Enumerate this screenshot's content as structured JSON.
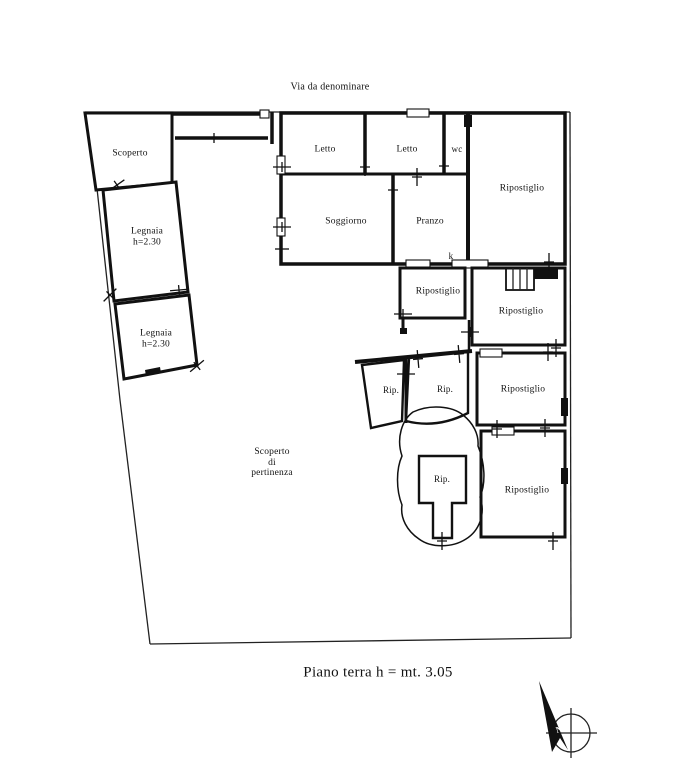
{
  "street_label": "Via da denominare",
  "caption": "Piano terra h = mt. 3.05",
  "rooms": {
    "scoperto": {
      "label": "Scoperto"
    },
    "legnaia_upper": {
      "label": "Legnaia",
      "height": "h=2.30"
    },
    "legnaia_lower": {
      "label": "Legnaia",
      "height": "h=2.30"
    },
    "letto_left": {
      "label": "Letto"
    },
    "letto_right": {
      "label": "Letto"
    },
    "wc": {
      "label": "wc"
    },
    "soggiorno": {
      "label": "Soggiorno"
    },
    "pranzo": {
      "label": "Pranzo"
    },
    "kitchen_mark": {
      "label": "k"
    },
    "ripostiglio_top_right": {
      "label": "Ripostiglio"
    },
    "ripostiglio_center": {
      "label": "Ripostiglio"
    },
    "ripostiglio_stair": {
      "label": "Ripostiglio"
    },
    "rip_small_left": {
      "label": "Rip."
    },
    "rip_small_right": {
      "label": "Rip."
    },
    "ripostiglio_mid_right": {
      "label": "Ripostiglio"
    },
    "ripostiglio_bottom_right": {
      "label": "Ripostiglio"
    },
    "rip_island": {
      "label": "Rip."
    },
    "courtyard": {
      "line1": "Scoperto",
      "line2": "di",
      "line3": "pertinenza"
    }
  },
  "compass": {
    "north_label": "N"
  },
  "colors": {
    "ink": "#111111",
    "paper": "#ffffff"
  }
}
